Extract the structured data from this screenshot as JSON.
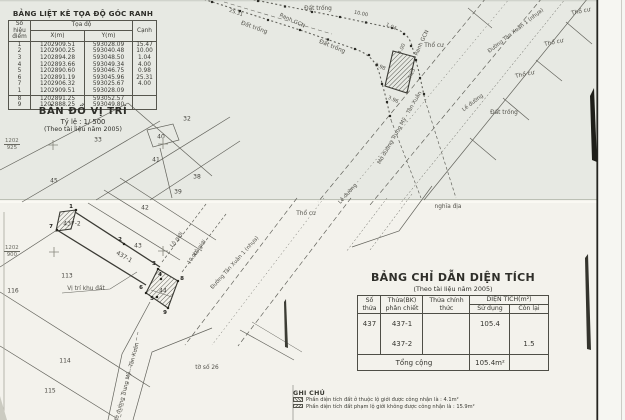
{
  "coord_table": {
    "title": "BẢNG LIỆT KÊ TỌA ĐỘ GÓC RANH",
    "header": {
      "point": "Số hiệu",
      "point2": "điểm",
      "coords": "Tọa độ",
      "x": "X(m)",
      "y": "Y(m)",
      "edge": "Cạnh"
    },
    "rows": [
      {
        "p": "1",
        "x": "1202909.51",
        "y": "593028.09",
        "c": "15.47"
      },
      {
        "p": "2",
        "x": "1202900.25",
        "y": "593040.48",
        "c": "10.00"
      },
      {
        "p": "3",
        "x": "1202894.28",
        "y": "593048.50",
        "c": "1.04"
      },
      {
        "p": "4",
        "x": "1202893.66",
        "y": "593049.34",
        "c": "4.00"
      },
      {
        "p": "5",
        "x": "1202890.60",
        "y": "593046.75",
        "c": "0.98"
      },
      {
        "p": "6",
        "x": "1202891.19",
        "y": "593045.96",
        "c": "25.31"
      },
      {
        "p": "7",
        "x": "1202906.32",
        "y": "593025.67",
        "c": "4.00"
      },
      {
        "p": "1",
        "x": "1202909.51",
        "y": "593028.09",
        "c": ""
      },
      {
        "p": "8",
        "x": "1202891.25",
        "y": "593052.57",
        "c": ""
      },
      {
        "p": "9",
        "x": "1202888.25",
        "y": "593049.80",
        "c": ""
      }
    ]
  },
  "location_map": {
    "title": "BẢN ĐỒ VỊ TRÍ",
    "scale": "Tỷ lệ : 1/ 500",
    "source": "(Theo tài liệu năm 2005)"
  },
  "grid_labels": {
    "top": {
      "x": "1202",
      "y": "925"
    },
    "bottom": {
      "x": "1202",
      "y": "900"
    }
  },
  "map_labels": {
    "dat_trong": "Đất trống",
    "tho_cu": "Thổ cư",
    "le_duong": "Lề đường",
    "lo_gioi": "Lộ giới",
    "nghia_dia": "nghĩa địa",
    "ranh_gcn": "Ranh GCN",
    "duong_tan_xuan_1": "Đường Tân Xuân 1 (nhựa)",
    "mo_duong_trung_my": "Mở đường Trung Mỹ - Tân Xuân",
    "vi_tri_khu_dat": "Vị trí khu đất",
    "to_so_26": "tờ số 26"
  },
  "parcels": {
    "n32": "32",
    "n33": "33",
    "n38": "38",
    "n39": "39",
    "n40": "40",
    "n41": "41",
    "n42": "42",
    "n43": "43",
    "n44": "44",
    "n45": "45",
    "n113": "113",
    "n114": "114",
    "n115": "115",
    "n116": "116",
    "s437_1": "437-1",
    "s437_2": "437-2"
  },
  "points": {
    "p1": "1",
    "p2": "2",
    "p3": "3",
    "p4": "4",
    "p5": "5",
    "p6": "6",
    "p7": "7",
    "p8": "8",
    "p9": "9"
  },
  "dims": {
    "d25_31": "25.31",
    "d10_00": "10.00",
    "d1_04": "1.04",
    "d4_00": "4.00",
    "d4_25": "4.25",
    "d0_98": "0.98",
    "d3_96": "3.96"
  },
  "area_table": {
    "title": "BẢNG CHỈ DẪN DIỆN TÍCH",
    "subtitle": "(Theo tài liệu năm 2005)",
    "header": {
      "so_thua": "Số thửa",
      "bk": "Thửa(BK) phân chiết",
      "chinh_thuc": "Thửa chính thức",
      "dien_tich": "DIỆN TÍCH(m²)",
      "su_dung": "Sử dụng",
      "con_lai": "Còn lại"
    },
    "rows": [
      {
        "so_thua": "437",
        "bk": "437-1",
        "chinh_thuc": "",
        "su_dung": "105.4",
        "con_lai": ""
      },
      {
        "so_thua": "",
        "bk": "437-2",
        "chinh_thuc": "",
        "su_dung": "",
        "con_lai": "1.5"
      }
    ],
    "total_label": "Tổng cộng",
    "total_su_dung": "105.4m²",
    "total_con_lai": ""
  },
  "notes": {
    "title": "GHI CHÚ",
    "items": [
      {
        "text": "Phần diện tích đất ở thuộc lộ giới được công nhận là : 4.1m²"
      },
      {
        "text": "Phần diện tích đất phạm lộ giới không được công nhận là : 15.9m²"
      }
    ]
  }
}
